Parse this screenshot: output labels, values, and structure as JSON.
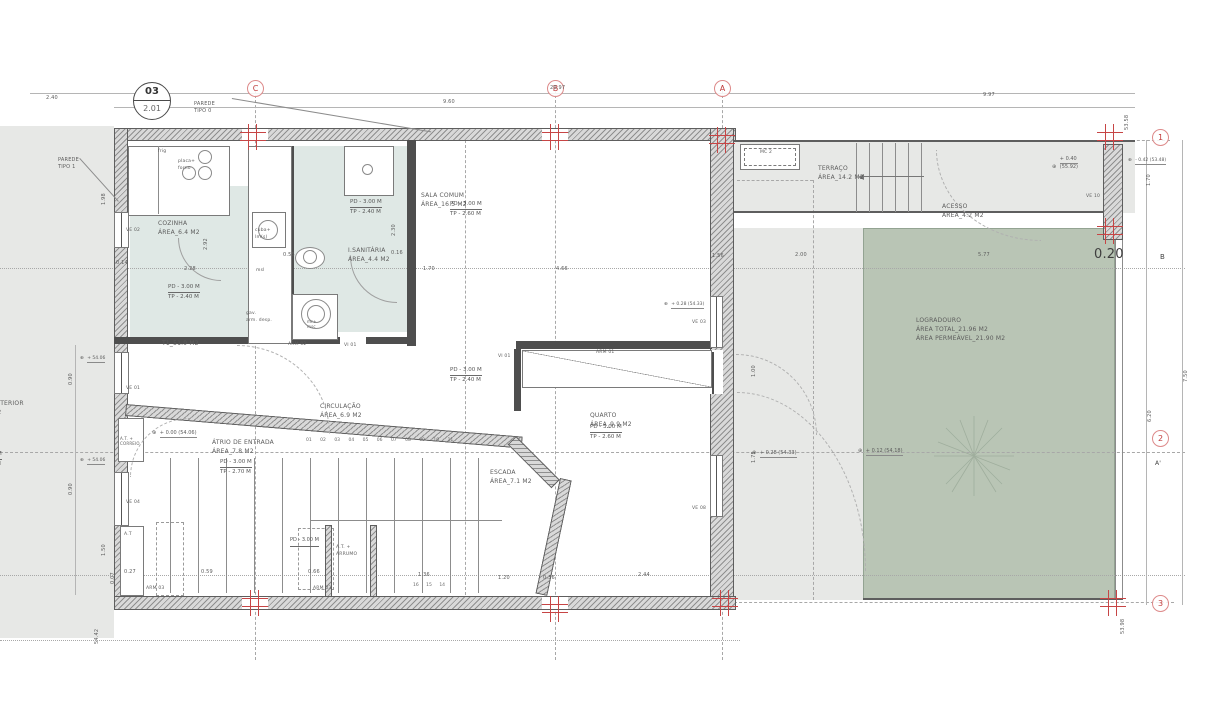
{
  "drawing": {
    "detail_marker": {
      "number": "03",
      "sheet": "2.01"
    },
    "wall_tags": {
      "tipo0_l1": "PAREDE",
      "tipo0_l2": "TIPO 0",
      "tipo1_l1": "PAREDE",
      "tipo1_l2": "TIPO 1"
    },
    "grid": {
      "c": "C",
      "b": "B",
      "a": "A",
      "n1": "1",
      "n2": "2",
      "n3": "3",
      "section_b": "B",
      "section_a": "A'"
    },
    "colors": {
      "accent_red": "#c13b3b",
      "garden_green": "#b9c5b5",
      "room_tint": "#dfe8e5",
      "exterior_gray": "#e7e8e6"
    }
  },
  "rooms": {
    "cozinha": {
      "name": "COZINHA",
      "area": "ÁREA_6.4 M2",
      "pd": "PD - 3.00 M",
      "tp": "TP - 2.40 M"
    },
    "isanitaria": {
      "name": "I.SANITÁRIA",
      "area": "ÁREA_4.4 M2",
      "pd": "PD - 3.00 M",
      "tp": "TP - 2.40 M"
    },
    "sala": {
      "name": "SALA COMUM",
      "area": "ÁREA_16.5 M2",
      "pd": "PD - 3.00 M",
      "tp": "TP - 2.60 M"
    },
    "circulacao": {
      "name": "CIRCULAÇÃO",
      "area": "ÁREA_6.9 M2",
      "pd": "PD - 3.00 M",
      "tp": "TP - 2.40 M"
    },
    "quarto": {
      "name": "QUARTO",
      "area": "ÁREA_9.9 M2",
      "pd": "PD - 3.00 M",
      "tp": "TP - 2.60 M"
    },
    "atrio": {
      "name": "ÁTRIO DE ENTRADA",
      "area": "ÁREA_7.8 M2",
      "pd": "PD - 3.00 M",
      "tp": "TP - 2.70 M"
    },
    "escada": {
      "name": "ESCADA",
      "area": "ÁREA_7.1 M2"
    },
    "terraco": {
      "name": "TERRAÇO",
      "area": "ÁREA_14.2 M2"
    },
    "acesso": {
      "name": "ACESSO",
      "area": "ÁREA_4.2 M2"
    },
    "logradouro": {
      "name": "LOGRADOURO",
      "area_total": "ÁREA TOTAL_21.96 M2",
      "area_perm": "ÁREA PERMEÁVEL_21.90 M2"
    },
    "exterior": {
      "name": "EXTERIOR",
      "area": "M2",
      "pd": "PD - 3.00 M",
      "tp": "TP - 2.70 M"
    },
    "unit": "T1_51.9 M2"
  },
  "fixtures": {
    "frig": "frig",
    "placa_l1": "placa+",
    "placa_l2": "forno",
    "cuba_l1": "cuba+",
    "cuba_l2": "lm(s)",
    "msl": "msl",
    "gav_l1": "gav.",
    "gav_l2": "arm. desp.",
    "wash_l1": "mr+",
    "wash_l2": "msc",
    "mc": "MC 2"
  },
  "openings": {
    "ve01": "VE 01",
    "ve02": "VE 02",
    "ve03": "VE 03",
    "ve04": "VE 04",
    "ve08": "VE 08",
    "ve10": "VE 10",
    "vi01a": "VI 01",
    "vi01b": "VI 01",
    "arm01": "ARM 01",
    "arm02": "ARM 02",
    "arm03a": "ARM 03",
    "arm03b": "ARM 03",
    "at": "A.T",
    "at_correio_l1": "A.T. +",
    "at_correio_l2": "CORREIO",
    "at_arrumo_l1": "A.T. +",
    "at_arrumo_l2": "ARRUMO",
    "pd_arrumo": "PD - 3.00 M"
  },
  "levels": {
    "icon": "⊕",
    "atrio": "+ 0.00 (54.06)",
    "patio1": "+ 0.28 (54.33)",
    "patio2": "+ 0.12 (54.18)",
    "quarto_lv": "+ 0.28 (54.33)",
    "terr_l1": "+ 0.40",
    "terr_l2": "(55.92)",
    "right_out": "- 0.42 (53.48)",
    "ext_a": "+ 54.06",
    "ext_b": "+ 54.06"
  },
  "dims": {
    "d240": "2.40",
    "d2097": "20.97",
    "d960": "9.60",
    "d997": "9.97",
    "d014": "0.14",
    "d228": "2.28",
    "d055": "0.55",
    "d170": "1.70",
    "d016": "0.16",
    "d466": "4.66",
    "d156": "1.56",
    "d200": "2.00",
    "d577": "5.77",
    "d020big": "0.20",
    "d027": "0.27",
    "d059": "0.59",
    "d066": "0.66",
    "d136": "1.36",
    "d120": "1.20",
    "d036": "0.36",
    "d244": "2.44",
    "d007": "0.07",
    "d198": "1.98",
    "d090a": "0.90",
    "d090b": "0.90",
    "d150": "1.50",
    "d5442": "54.42",
    "d5358": "53.58",
    "dr170": "1.70",
    "d750": "7.50",
    "d620": "6.20",
    "d5398": "53.98",
    "d292": "2.92",
    "d230": "2.30",
    "d100": "1.00",
    "d175": "1.75"
  },
  "stairs": {
    "upper": "01 02 03 04 05 06 07 08 09 10 11",
    "lower": "16 15 14"
  }
}
